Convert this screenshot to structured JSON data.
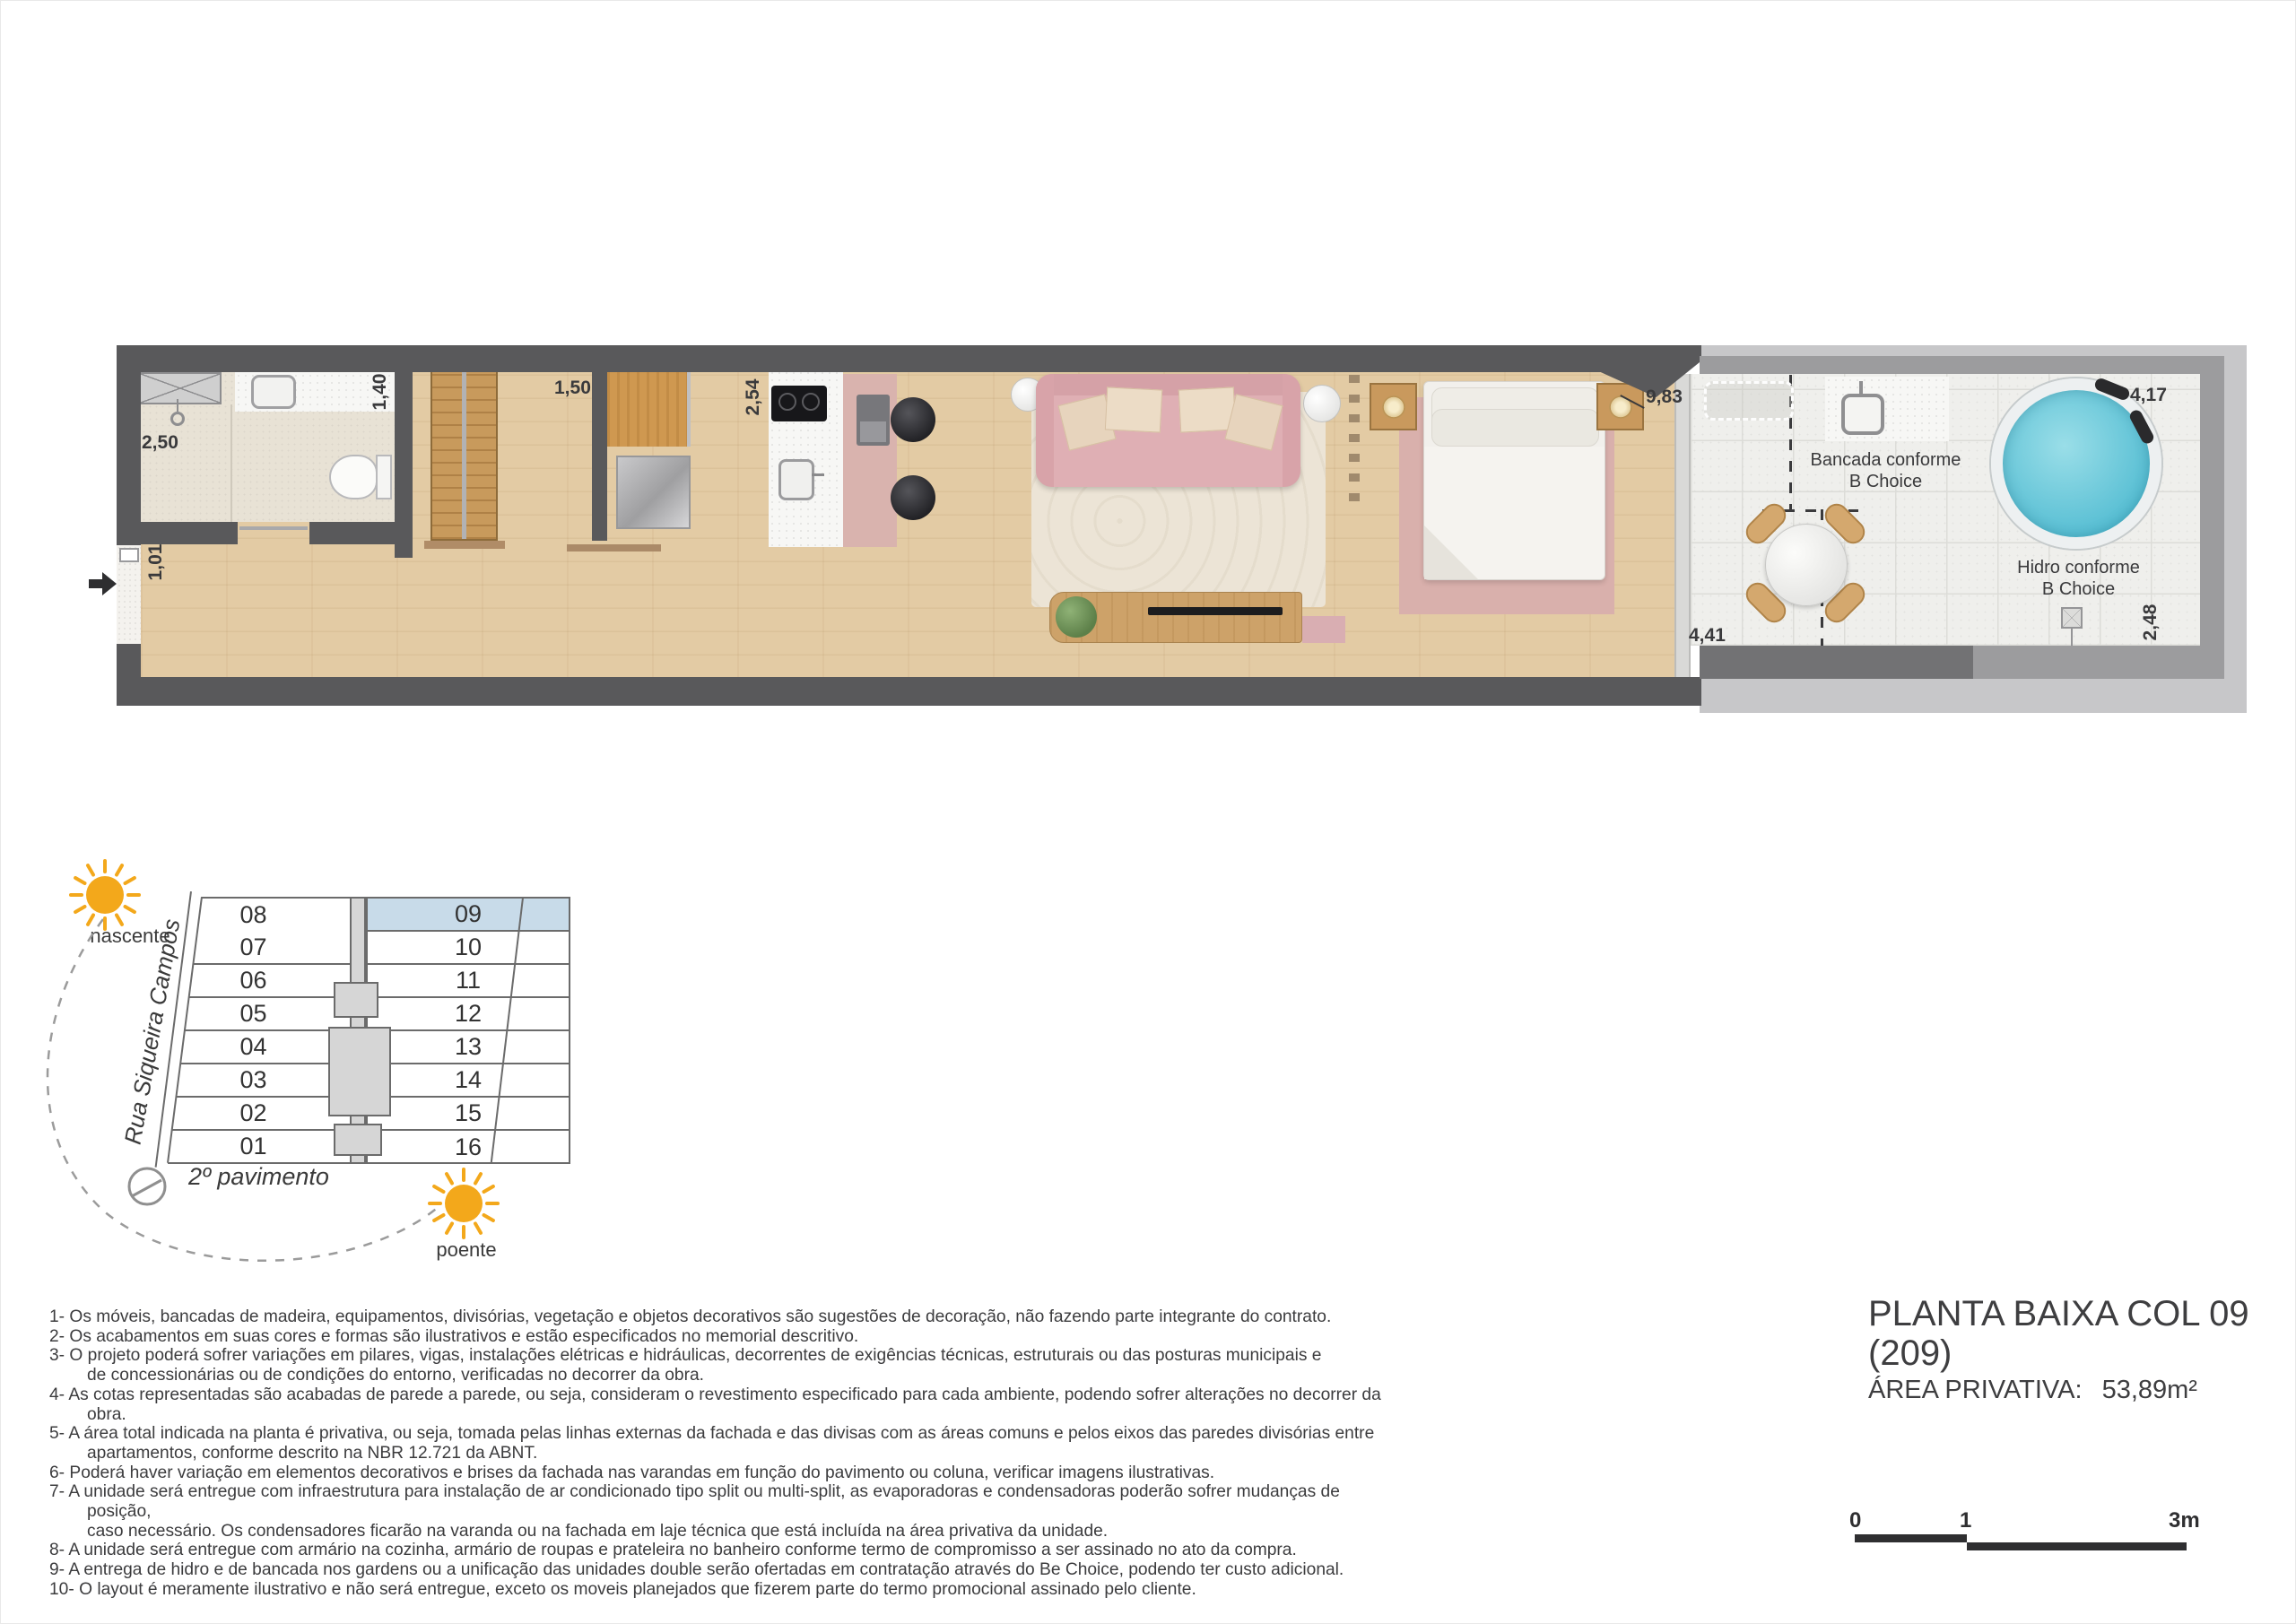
{
  "plan": {
    "dims": {
      "bath": "2,50",
      "counter": "1,40",
      "hall": "1,01",
      "closet": "1,50",
      "kitchen": "2,54",
      "bedroom": "9,83",
      "garden_bottom": "4,41",
      "garden_top": "4,17",
      "garden_right": "2,48"
    },
    "labels": {
      "bancada": "Bancada conforme\nB Choice",
      "hidro": "Hidro conforme\nB Choice"
    },
    "colors": {
      "wall_dark": "#59595b",
      "garden_wall": "#9c9c9e",
      "sofa_pink": "#dfafb4",
      "hidro_water": "#52bcd2",
      "wood_floor": "#e3cba4"
    }
  },
  "keyplan": {
    "street": "Rua Siqueira Campos",
    "floor_label": "2º pavimento",
    "sun_east_label": "nascente",
    "sun_west_label": "poente",
    "left_units": [
      "08",
      "07",
      "06",
      "05",
      "04",
      "03",
      "02",
      "01"
    ],
    "right_units": [
      "09",
      "10",
      "11",
      "12",
      "13",
      "14",
      "15",
      "16"
    ],
    "highlighted_unit": "09",
    "highlight_color": "#c8dbe9",
    "sun_color": "#f3a81b"
  },
  "icons": {
    "sun_icon": "radiating-sun",
    "north_arrow_icon": "compass-circle-needle",
    "entrance_arrow_icon": "solid-right-arrow",
    "drain_icon": "crossed-square"
  },
  "notes": [
    "1- Os móveis, bancadas de madeira, equipamentos, divisórias, vegetação e objetos decorativos são sugestões de decoração, não fazendo parte integrante do contrato.",
    "2- Os acabamentos em suas cores e formas são ilustrativos e estão especificados no memorial descritivo.",
    "3- O projeto poderá sofrer variações em pilares, vigas, instalações elétricas e hidráulicas, decorrentes de exigências técnicas, estruturais ou das posturas municipais e\nde concessionárias ou de condições do entorno, verificadas no decorrer da obra.",
    "4- As cotas representadas são acabadas de parede a parede, ou seja, consideram o revestimento especificado para cada ambiente, podendo sofrer alterações no decorrer da obra.",
    "5- A área total indicada na planta é privativa, ou seja, tomada pelas linhas externas da fachada e das divisas com as áreas comuns e pelos eixos das paredes divisórias entre\napartamentos, conforme descrito na NBR 12.721 da ABNT.",
    "6- Poderá haver variação em elementos decorativos e brises da fachada nas varandas em função do pavimento ou coluna, verificar imagens ilustrativas.",
    "7- A unidade será entregue com infraestrutura para instalação de ar condicionado tipo split ou multi-split, as evaporadoras e condensadoras poderão sofrer mudanças de posição,\ncaso necessário. Os condensadores ficarão na varanda ou na fachada em laje técnica que está incluída na área privativa da unidade.",
    "8- A unidade será entregue com armário na cozinha, armário de roupas e prateleira no banheiro conforme termo de compromisso a ser assinado no ato da compra.",
    "9- A entrega de hidro e de bancada nos gardens ou a unificação das unidades double serão ofertadas em contratação através do Be Choice, podendo ter custo adicional.",
    "10- O layout é meramente ilustrativo e não será entregue, exceto os moveis planejados que fizerem parte do termo promocional assinado pelo cliente."
  ],
  "title": {
    "line1": "PLANTA BAIXA COL 09",
    "line2": "(209)",
    "area_label": "ÁREA PRIVATIVA:",
    "area_value": "53,89m²"
  },
  "scale": {
    "t0": "0",
    "t1": "1",
    "t3": "3m"
  }
}
